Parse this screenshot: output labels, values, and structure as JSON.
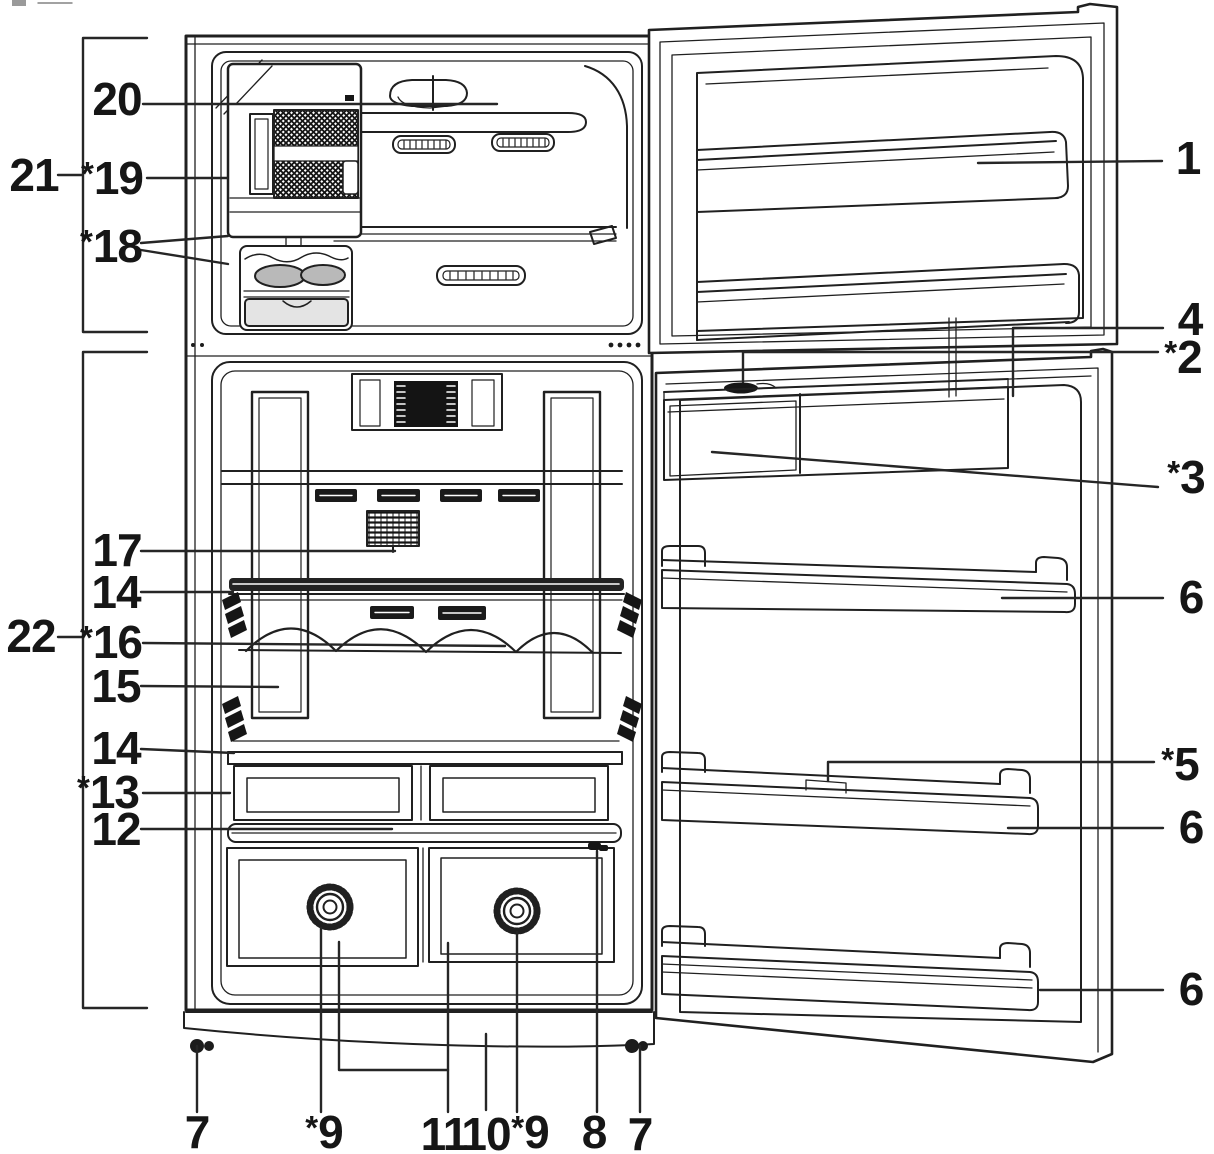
{
  "figure": {
    "type": "parts-diagram",
    "subject": "top-freezer refrigerator with freezer and fresh-food doors open, numbered parts callouts",
    "colors": {
      "background": "#ffffff",
      "line": "#202020",
      "label_text": "#161616",
      "ice_tray_fill": "#b9b9b9",
      "ice_bin_fill": "#e4e4e4",
      "vent_fill": "#1a1a1a"
    },
    "callouts": [
      {
        "id": "20",
        "text": "20",
        "x": 117,
        "y": 99,
        "leaders": [
          [
            [
              143,
              104
            ],
            [
              497,
              104
            ]
          ]
        ]
      },
      {
        "id": "21",
        "text": "21",
        "x": 34,
        "y": 175,
        "leaders": [
          [
            [
              58,
              175
            ],
            [
              82,
              175
            ]
          ],
          [
            [
              147,
              38
            ],
            [
              83,
              38
            ],
            [
              83,
              332
            ],
            [
              147,
              332
            ]
          ]
        ]
      },
      {
        "id": "19",
        "text": "*19",
        "x": 112,
        "y": 178,
        "leaders": [
          [
            [
              147,
              178
            ],
            [
              227,
              178
            ]
          ]
        ]
      },
      {
        "id": "18",
        "text": "*18",
        "x": 111,
        "y": 246,
        "leaders": [
          [
            [
              141,
              243
            ],
            [
              228,
              236
            ]
          ],
          [
            [
              141,
              250
            ],
            [
              228,
              264
            ]
          ]
        ]
      },
      {
        "id": "17",
        "text": "17",
        "x": 117,
        "y": 550,
        "leaders": [
          [
            [
              141,
              551
            ],
            [
              395,
              551
            ]
          ]
        ]
      },
      {
        "id": "14a",
        "text": "14",
        "x": 116,
        "y": 592,
        "leaders": [
          [
            [
              141,
              592
            ],
            [
              233,
              592
            ]
          ]
        ]
      },
      {
        "id": "22",
        "text": "22",
        "x": 31,
        "y": 636,
        "leaders": [
          [
            [
              58,
              637
            ],
            [
              82,
              637
            ]
          ],
          [
            [
              147,
              352
            ],
            [
              83,
              352
            ],
            [
              83,
              1008
            ],
            [
              147,
              1008
            ]
          ]
        ]
      },
      {
        "id": "16",
        "text": "*16",
        "x": 111,
        "y": 642,
        "leaders": [
          [
            [
              143,
              643
            ],
            [
              505,
              646
            ]
          ]
        ]
      },
      {
        "id": "15",
        "text": "15",
        "x": 116,
        "y": 686,
        "leaders": [
          [
            [
              141,
              686
            ],
            [
              278,
              687
            ]
          ]
        ]
      },
      {
        "id": "14b",
        "text": "14",
        "x": 116,
        "y": 748,
        "leaders": [
          [
            [
              141,
              749
            ],
            [
              234,
              753
            ]
          ]
        ]
      },
      {
        "id": "13",
        "text": "*13",
        "x": 108,
        "y": 792,
        "leaders": [
          [
            [
              143,
              793
            ],
            [
              230,
              793
            ]
          ]
        ]
      },
      {
        "id": "12",
        "text": "12",
        "x": 116,
        "y": 829,
        "leaders": [
          [
            [
              141,
              829
            ],
            [
              392,
              829
            ]
          ]
        ]
      },
      {
        "id": "1",
        "text": "1",
        "x": 1188,
        "y": 158,
        "leaders": [
          [
            [
              1162,
              161
            ],
            [
              978,
              163
            ]
          ]
        ]
      },
      {
        "id": "4",
        "text": "4",
        "x": 1190,
        "y": 319,
        "leaders": [
          [
            [
              1163,
              328
            ],
            [
              1013,
              328
            ],
            [
              1013,
              396
            ]
          ]
        ]
      },
      {
        "id": "2",
        "text": "*2",
        "x": 1183,
        "y": 357,
        "leaders": [
          [
            [
              1158,
              352
            ],
            [
              743,
              352
            ],
            [
              743,
              382
            ]
          ]
        ]
      },
      {
        "id": "3",
        "text": "*3",
        "x": 1186,
        "y": 477,
        "leaders": [
          [
            [
              1158,
              487
            ],
            [
              712,
              452
            ]
          ]
        ]
      },
      {
        "id": "6a",
        "text": "6",
        "x": 1191,
        "y": 597,
        "leaders": [
          [
            [
              1163,
              598
            ],
            [
              1002,
              598
            ]
          ]
        ]
      },
      {
        "id": "5",
        "text": "*5",
        "x": 1180,
        "y": 764,
        "leaders": [
          [
            [
              1154,
              762
            ],
            [
              828,
              762
            ],
            [
              828,
              781
            ]
          ]
        ]
      },
      {
        "id": "6b",
        "text": "6",
        "x": 1191,
        "y": 827,
        "leaders": [
          [
            [
              1163,
              828
            ],
            [
              1008,
              828
            ]
          ]
        ]
      },
      {
        "id": "6c",
        "text": "6",
        "x": 1191,
        "y": 989,
        "leaders": [
          [
            [
              1163,
              990
            ],
            [
              1040,
              990
            ]
          ]
        ]
      },
      {
        "id": "7a",
        "text": "7",
        "x": 197,
        "y": 1132,
        "leaders": [
          [
            [
              197,
              1112
            ],
            [
              197,
              1046
            ]
          ]
        ]
      },
      {
        "id": "9a",
        "text": "*9",
        "x": 324,
        "y": 1132,
        "leaders": [
          [
            [
              321,
              1112
            ],
            [
              321,
              928
            ]
          ]
        ]
      },
      {
        "id": "11",
        "text": "11",
        "x": 444,
        "y": 1134,
        "leaders": [
          [
            [
              448,
              1112
            ],
            [
              448,
              943
            ]
          ],
          [
            [
              339,
              942
            ],
            [
              339,
              1070
            ],
            [
              448,
              1070
            ]
          ]
        ]
      },
      {
        "id": "10",
        "text": "10",
        "x": 486,
        "y": 1134,
        "leaders": [
          [
            [
              486,
              1110
            ],
            [
              486,
              1034
            ]
          ]
        ]
      },
      {
        "id": "9b",
        "text": "*9",
        "x": 530,
        "y": 1132,
        "leaders": [
          [
            [
              517,
              1112
            ],
            [
              517,
              932
            ]
          ]
        ]
      },
      {
        "id": "8",
        "text": "8",
        "x": 594,
        "y": 1132,
        "leaders": [
          [
            [
              597,
              1112
            ],
            [
              597,
              851
            ]
          ]
        ]
      },
      {
        "id": "7b",
        "text": "7",
        "x": 640,
        "y": 1134,
        "leaders": [
          [
            [
              640,
              1112
            ],
            [
              640,
              1046
            ]
          ]
        ]
      }
    ]
  }
}
